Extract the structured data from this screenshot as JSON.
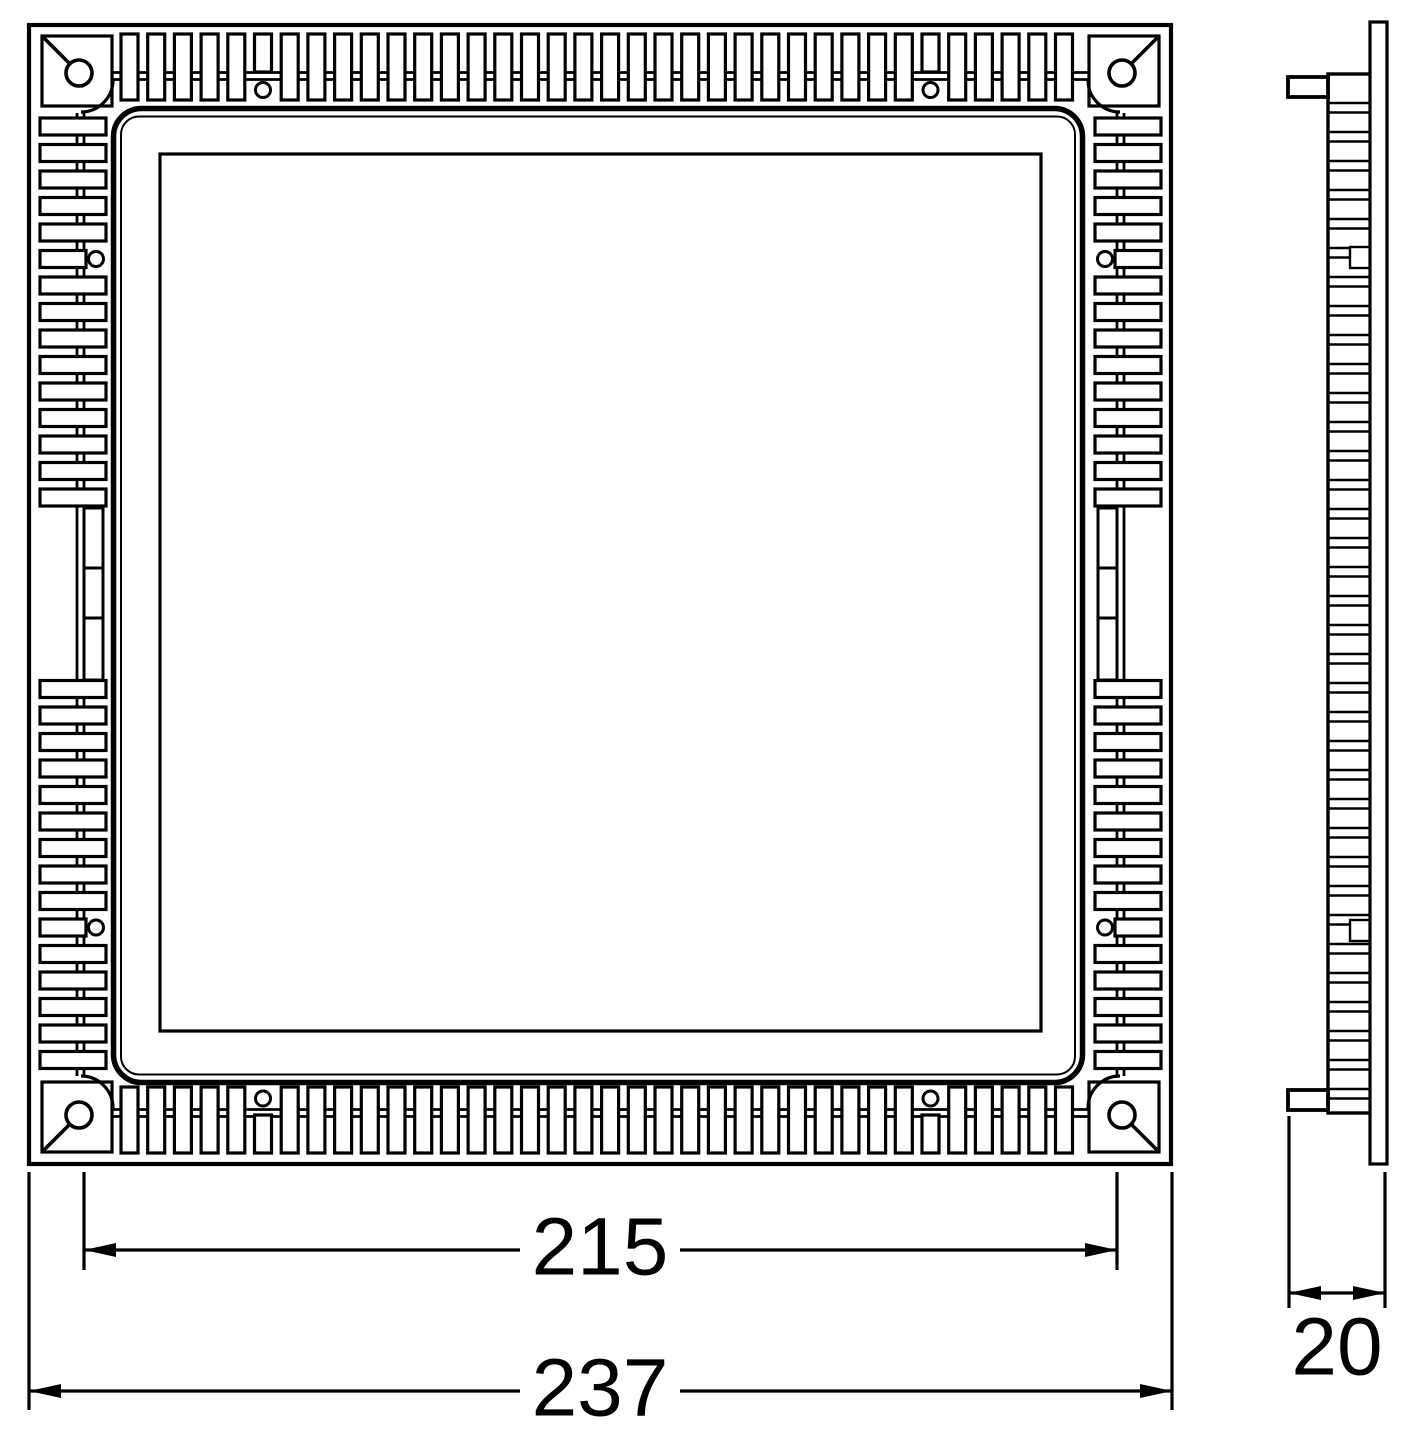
{
  "page": {
    "background": "#ffffff",
    "line_color": "#000000"
  },
  "drawing": {
    "type": "technical dimension drawing",
    "views": [
      "front view",
      "side profile view"
    ]
  },
  "dimensions": {
    "inner": {
      "label": "215"
    },
    "outer": {
      "label": "237"
    },
    "depth": {
      "label": "20"
    }
  }
}
